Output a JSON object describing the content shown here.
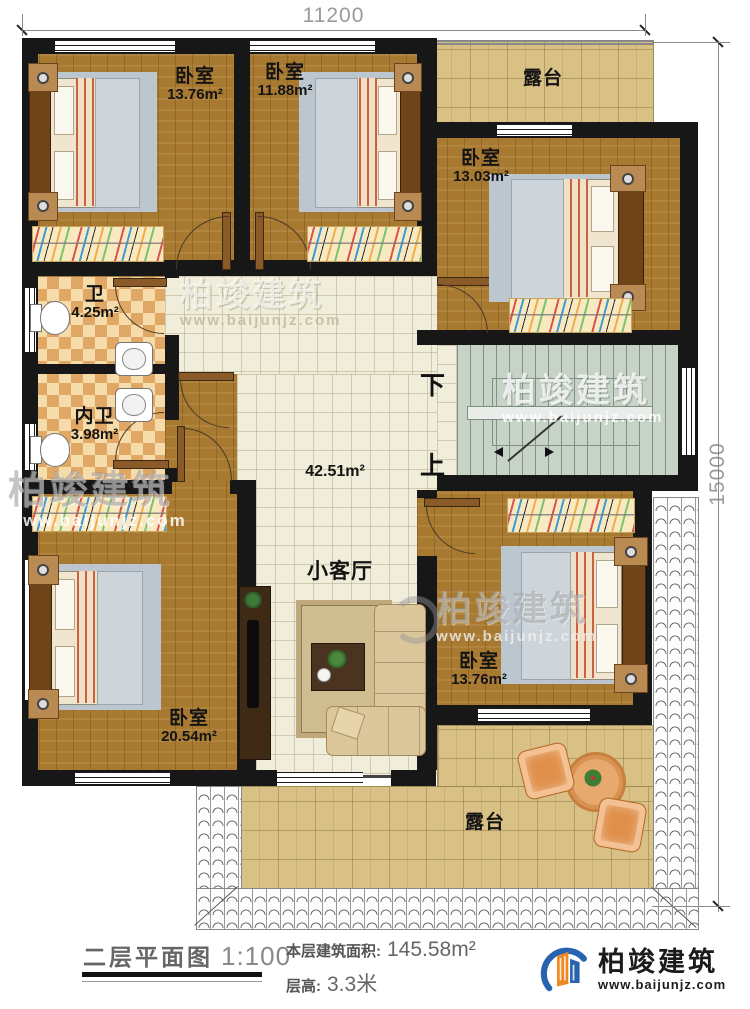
{
  "dimensions": {
    "width_mm": "11200",
    "height_mm": "15000"
  },
  "rooms": {
    "bedroom_top_left": {
      "name": "卧室",
      "area": "13.76m²"
    },
    "bedroom_top_mid": {
      "name": "卧室",
      "area": "11.88m²"
    },
    "bedroom_right": {
      "name": "卧室",
      "area": "13.03m²"
    },
    "bedroom_bottom_left": {
      "name": "卧室",
      "area": "20.54m²"
    },
    "bedroom_bottom_right": {
      "name": "卧室",
      "area": "13.76m²"
    },
    "bath": {
      "name": "卫",
      "area": "4.25m²"
    },
    "inner_bath": {
      "name": "内卫",
      "area": "3.98m²"
    },
    "hall": {
      "area": "42.51m²"
    },
    "living": {
      "name": "小客厅"
    },
    "terrace_top": {
      "name": "露台"
    },
    "terrace_bottom": {
      "name": "露台"
    }
  },
  "stairs": {
    "down_label": "下",
    "up_label": "上"
  },
  "title_block": {
    "plan_title": "二层平面图",
    "scale": "1:100",
    "area_label": "本层建筑面积:",
    "area_value": "145.58m²",
    "height_label": "层高:",
    "height_value": "3.3米"
  },
  "brand": {
    "name": "柏竣建筑",
    "website": "www.baijunjz.com"
  },
  "watermark": {
    "name": "柏竣建筑",
    "website": "www.baijunjz.com"
  },
  "colors": {
    "wall": "#171717",
    "wood_floor": "#a87a31",
    "tile_floor": "#f0edda",
    "bath_floor": "#e0a765",
    "stair": "#c8d3c8",
    "terrace": "#d9c084",
    "brand_blue": "#2763ae",
    "brand_orange": "#f0861f"
  }
}
